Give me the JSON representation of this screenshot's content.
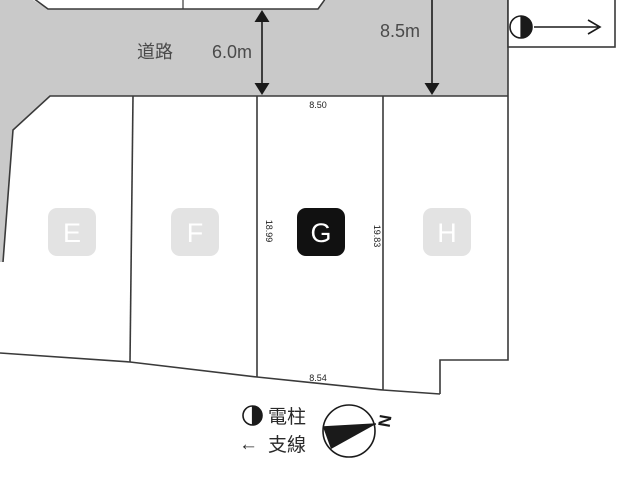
{
  "road": {
    "label": "道路",
    "width_main": "6.0m",
    "width_secondary": "8.5m"
  },
  "plots": {
    "e": {
      "label": "E",
      "highlighted": false
    },
    "f": {
      "label": "F",
      "highlighted": false
    },
    "g": {
      "label": "G",
      "highlighted": true
    },
    "h": {
      "label": "H",
      "highlighted": false
    }
  },
  "dimensions": {
    "g_top": "8.50",
    "g_left_side": "18.99",
    "g_right_side": "19.83",
    "g_bottom": "8.54"
  },
  "legend": {
    "pole_label": "電柱",
    "guy_arrow": "←",
    "guy_label": "支線",
    "north_label": "N"
  },
  "colors": {
    "road_fill": "#c9c9c9",
    "plot_chip_fill": "#e3e3e3",
    "selected_chip_fill": "#111111",
    "chip_letter": "#ffffff",
    "line": "#3a3a3a",
    "road_text": "#4a4a4a",
    "dimension_text": "#222222"
  }
}
